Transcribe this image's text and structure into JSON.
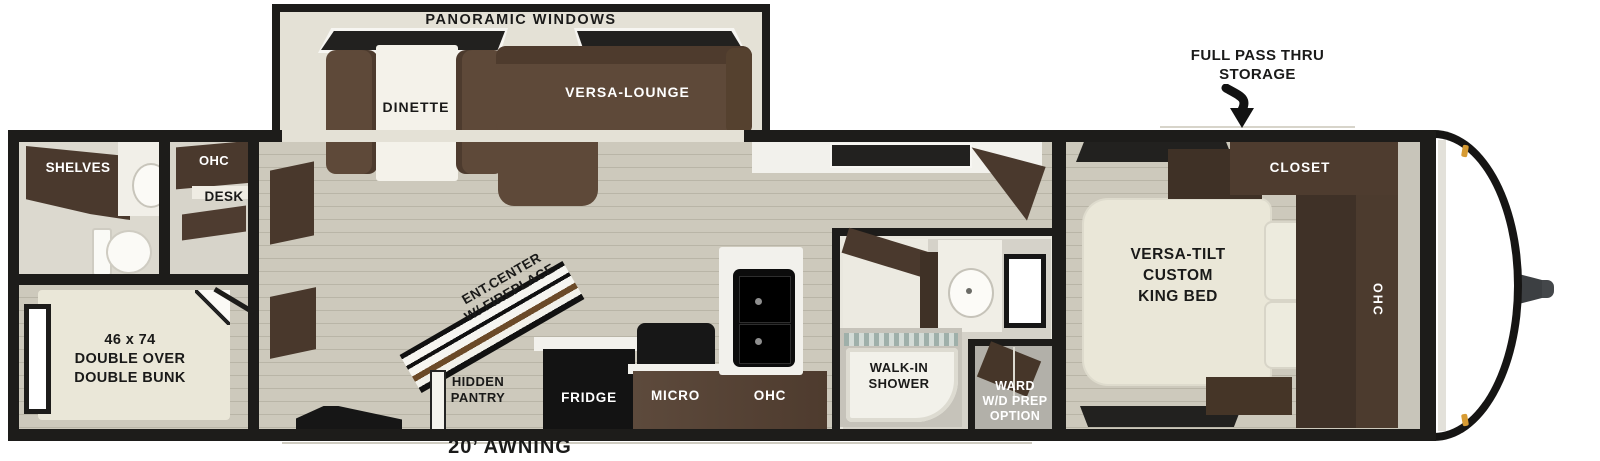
{
  "labels": {
    "panoramic_windows": "PANORAMIC WINDOWS",
    "dinette": "DINETTE",
    "versa_lounge": "VERSA-LOUNGE",
    "shelves": "SHELVES",
    "rear_ohc": "OHC",
    "desk": "DESK",
    "bunk": "46 x 74\nDOUBLE OVER\nDOUBLE BUNK",
    "ent_center": "ENT.CENTER\nW/ FIREPLACE",
    "hidden_pantry": "HIDDEN\nPANTRY",
    "fridge": "FRIDGE",
    "micro": "MICRO",
    "kitchen_ohc": "OHC",
    "walk_in_shower": "WALK-IN\nSHOWER",
    "ward": "WARD\nW/D PREP\nOPTION",
    "king_bed": "VERSA-TILT\nCUSTOM\nKING BED",
    "closet": "CLOSET",
    "bedroom_ohc": "OHC",
    "full_pass_thru": "FULL PASS THRU\nSTORAGE",
    "awning": "20’ AWNING"
  },
  "colors": {
    "wall": "#1d1c1a",
    "floor": "#cbc7b9",
    "floorline": "#b9b5a7",
    "cabinet": "#4a392d",
    "cabinetdark": "#3f3126",
    "sofa": "#5e4939",
    "sofadark": "#4e3b2d",
    "cream": "#eae7d8",
    "surface": "#f2f1ec",
    "bathbg": "#d5d2c9",
    "windowdark": "#22211f",
    "amber": "#d79b33",
    "hitch": "#3c3f42",
    "textdark": "#1a1a19",
    "textlight": "#ffffff"
  }
}
